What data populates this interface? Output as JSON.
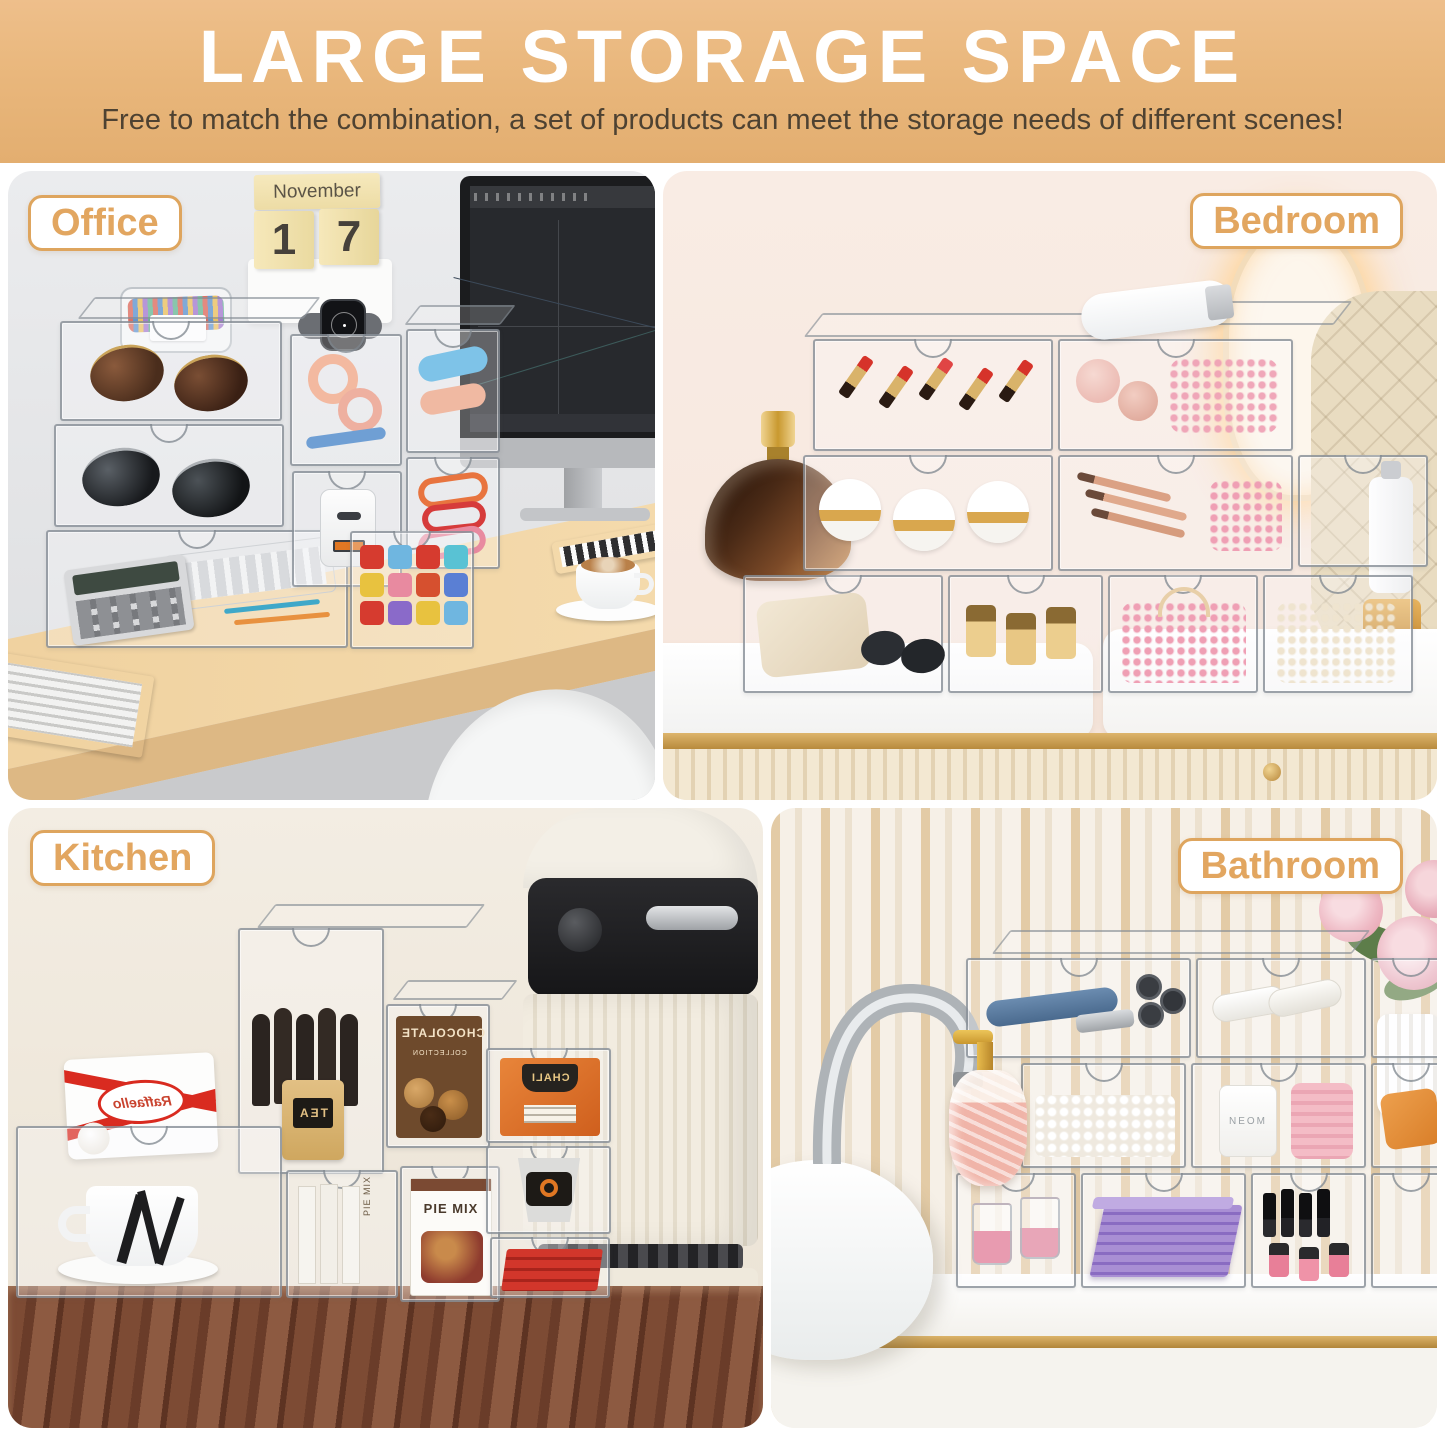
{
  "header": {
    "title": "LARGE STORAGE SPACE",
    "subtitle": "Free to match the combination, a set of products can meet the storage needs of different scenes!"
  },
  "scenes": [
    {
      "id": "office",
      "label": "Office"
    },
    {
      "id": "bedroom",
      "label": "Bedroom"
    },
    {
      "id": "kitchen",
      "label": "Kitchen"
    },
    {
      "id": "bathroom",
      "label": "Bathroom"
    }
  ],
  "office": {
    "calendar": {
      "month": "November",
      "day_tens": "1",
      "day_ones": "7"
    }
  },
  "kitchen": {
    "raffaello_label": "Raffaello",
    "chocolate_label": "CHOCOLATE",
    "collection_label": "COLLECTION",
    "tea_label": "TEA",
    "chali_label": "CHALI",
    "pie_mix_label": "PIE MIX"
  },
  "bathroom": {
    "candle_label": "NEOM"
  },
  "colors": {
    "header_background": "#e9b77c",
    "header_title": "#ffffff",
    "header_subtitle": "#4e4232",
    "badge_text": "#e2a660",
    "badge_border": "#dea55e",
    "page_background": "#ffffff"
  }
}
